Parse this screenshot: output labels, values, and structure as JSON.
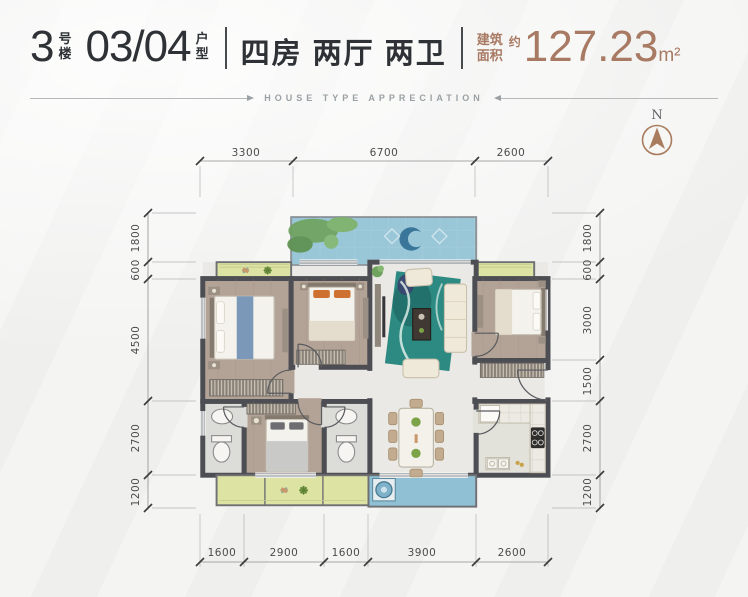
{
  "header": {
    "building_number": "3",
    "building_suffix": "号楼",
    "unit_number": "03/04",
    "unit_suffix": "户型",
    "rooms_summary": "四房 两厅 两卫",
    "area_label": "建筑面积",
    "area_prefix": "约",
    "area_value": "127.23",
    "area_unit": "m²",
    "subtitle": "HOUSE TYPE APPRECIATION"
  },
  "compass": {
    "north_label": "N"
  },
  "dimensions": {
    "top": [
      "3300",
      "6700",
      "2600"
    ],
    "bottom": [
      "1600",
      "2900",
      "1600",
      "3900",
      "2600"
    ],
    "left": [
      "1800",
      "600",
      "4500",
      "2700",
      "1200"
    ],
    "right": [
      "1800",
      "600",
      "3000",
      "1500",
      "2700",
      "1200"
    ]
  },
  "colors": {
    "accent_brown": "#a87a64",
    "title_dark": "#2e3236",
    "wall": "#4d4e53",
    "balcony_blue": "#9ac7d8",
    "bay_green": "#dde3a3",
    "wood_floor": "#b3a396",
    "marble_floor": "#eae9e5",
    "rug_teal": "#2d8a82"
  }
}
